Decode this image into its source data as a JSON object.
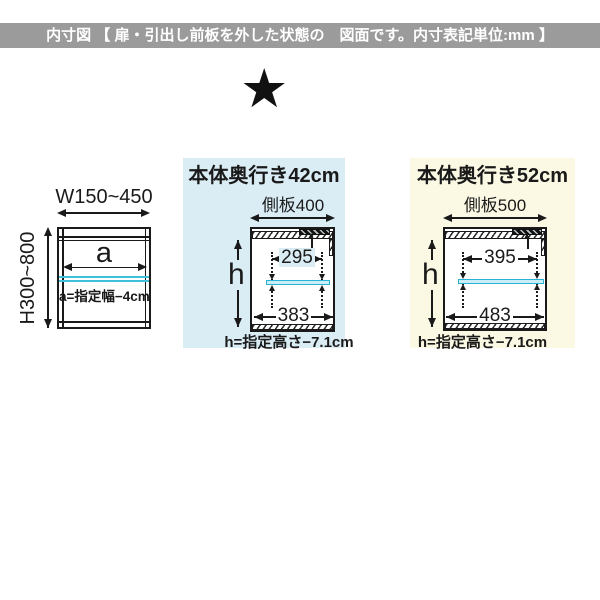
{
  "header": {
    "title": "内寸図 【 扉・引出し前板を外した状態の　図面です。内寸表記単位:mm 】"
  },
  "marker": {
    "star": "★"
  },
  "colors": {
    "header_bg": "#9b9b9b",
    "panel_blue": "#daedf5",
    "panel_yellow": "#fbf9e3",
    "shelf_cyan": "#28b2d4",
    "line": "#1a1a1a"
  },
  "left_diagram": {
    "width_range": "W150~450",
    "height_range": "H300~800",
    "inner_width_symbol": "a",
    "inner_width_formula": "a=指定幅−4cm"
  },
  "middle_diagram": {
    "title": "本体奥行き42cm",
    "side_panel": "側板400",
    "height_symbol": "h",
    "upper_inner_width": "295",
    "lower_inner_width": "383",
    "height_formula": "h=指定高さ−7.1cm"
  },
  "right_diagram": {
    "title": "本体奥行き52cm",
    "side_panel": "側板500",
    "height_symbol": "h",
    "upper_inner_width": "395",
    "lower_inner_width": "483",
    "height_formula": "h=指定高さ−7.1cm"
  }
}
